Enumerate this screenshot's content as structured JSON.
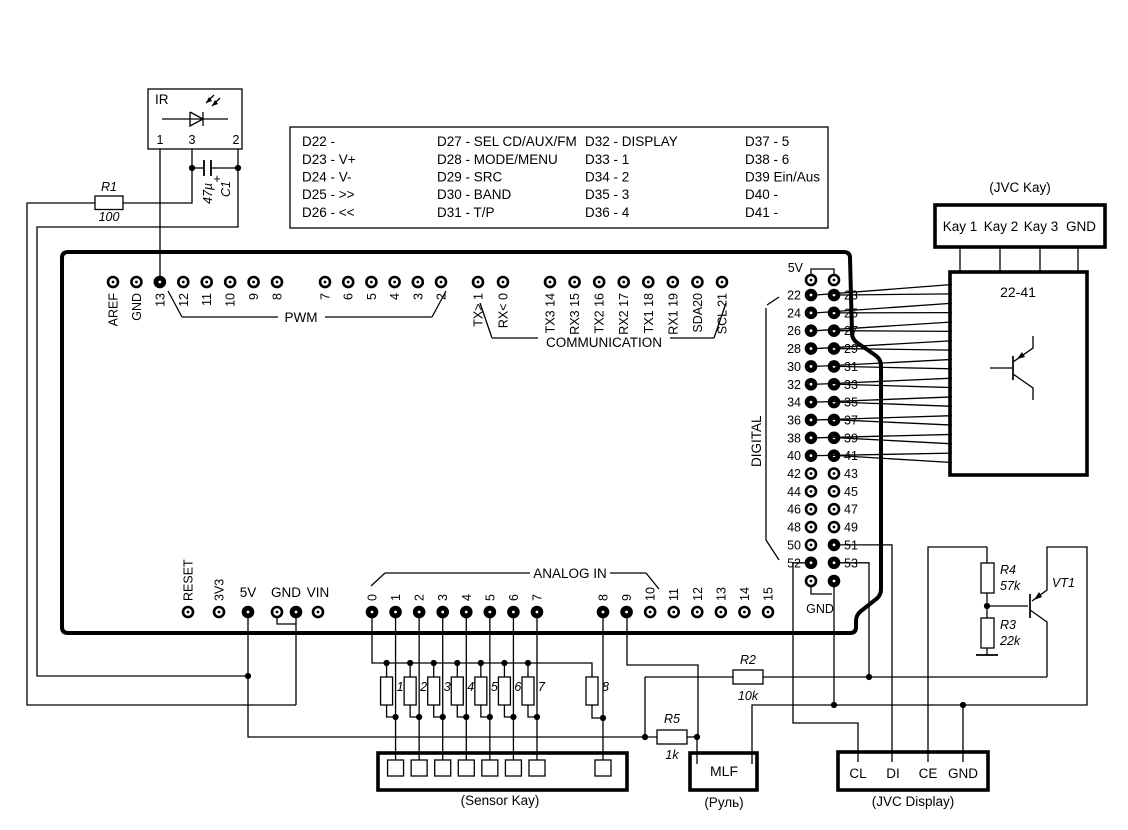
{
  "ir_module": {
    "label": "IR",
    "pin_numbers": [
      "1",
      "3",
      "2"
    ]
  },
  "components": {
    "r1_name": "R1",
    "r1_value": "100",
    "c1_plus": "+",
    "c1_name": "C1",
    "c1_value": "47µ",
    "r2_name": "R2",
    "r2_value": "10k",
    "r5_name": "R5",
    "r5_value": "1k",
    "r4_name": "R4",
    "r4_value": "57k",
    "r3_name": "R3",
    "r3_value": "22k",
    "vt1_name": "VT1"
  },
  "pin_function_table": {
    "columns": [
      [
        "D22 -",
        "D23 - V+",
        "D24 - V-",
        "D25 - >>",
        "D26 - <<"
      ],
      [
        "D27 - SEL CD/AUX/FM",
        "D28 - MODE/MENU",
        "D29 - SRC",
        "D30 - BAND",
        "D31 - T/P"
      ],
      [
        "D32 - DISPLAY",
        "D33 - 1",
        "D34 - 2",
        "D35 - 3",
        "D36 - 4"
      ],
      [
        "D37 - 5",
        "D38 - 6",
        "D39 Ein/Aus",
        "D40 -",
        "D41 -"
      ]
    ]
  },
  "board": {
    "top_pins_left": [
      "AREF",
      "GND",
      "13",
      "12",
      "11",
      "10",
      "9",
      "8"
    ],
    "top_pins_right": [
      "7",
      "6",
      "5",
      "4",
      "3",
      "2"
    ],
    "comm_pins_left": [
      "TX> 1",
      "RX< 0"
    ],
    "comm_pins_right": [
      "TX3 14",
      "RX3 15",
      "TX2 16",
      "RX2 17",
      "TX1 18",
      "RX1 19",
      "SDA20",
      "SCL 21"
    ],
    "labels": {
      "pwm": "PWM",
      "communication": "COMMUNICATION",
      "digital": "DIGITAL",
      "analog_in": "ANALOG IN",
      "header_5v": "5V",
      "header_gnd": "GND"
    },
    "bottom_pins": [
      "RESET",
      "3V3",
      "5V",
      "GND",
      "VIN"
    ],
    "analog_pins_left": [
      "0",
      "1",
      "2",
      "3",
      "4",
      "5",
      "6",
      "7"
    ],
    "analog_pins_right": [
      "8",
      "9",
      "10",
      "11",
      "12",
      "13",
      "14",
      "15"
    ],
    "digital_rows": [
      [
        "22",
        "23"
      ],
      [
        "24",
        "25"
      ],
      [
        "26",
        "27"
      ],
      [
        "28",
        "29"
      ],
      [
        "30",
        "31"
      ],
      [
        "32",
        "33"
      ],
      [
        "34",
        "35"
      ],
      [
        "36",
        "37"
      ],
      [
        "38",
        "39"
      ],
      [
        "40",
        "41"
      ],
      [
        "42",
        "43"
      ],
      [
        "44",
        "45"
      ],
      [
        "46",
        "47"
      ],
      [
        "48",
        "49"
      ],
      [
        "50",
        "51"
      ],
      [
        "52",
        "53"
      ]
    ]
  },
  "jvc_kay": {
    "caption": "(JVC Kay)",
    "pins": [
      "Kay 1",
      "Kay 2",
      "Kay 3",
      "GND"
    ]
  },
  "driver_box": {
    "title": "22-41"
  },
  "sensor_box": {
    "caption": "(Sensor Kay)",
    "resistor_numbers": [
      "1",
      "2",
      "3",
      "4",
      "5",
      "6",
      "7",
      "8"
    ]
  },
  "mlf_box": {
    "title": "MLF",
    "caption": "(Руль)"
  },
  "jvc_display": {
    "caption": "(JVC Display)",
    "pins": [
      "CL",
      "DI",
      "CE",
      "GND"
    ]
  }
}
